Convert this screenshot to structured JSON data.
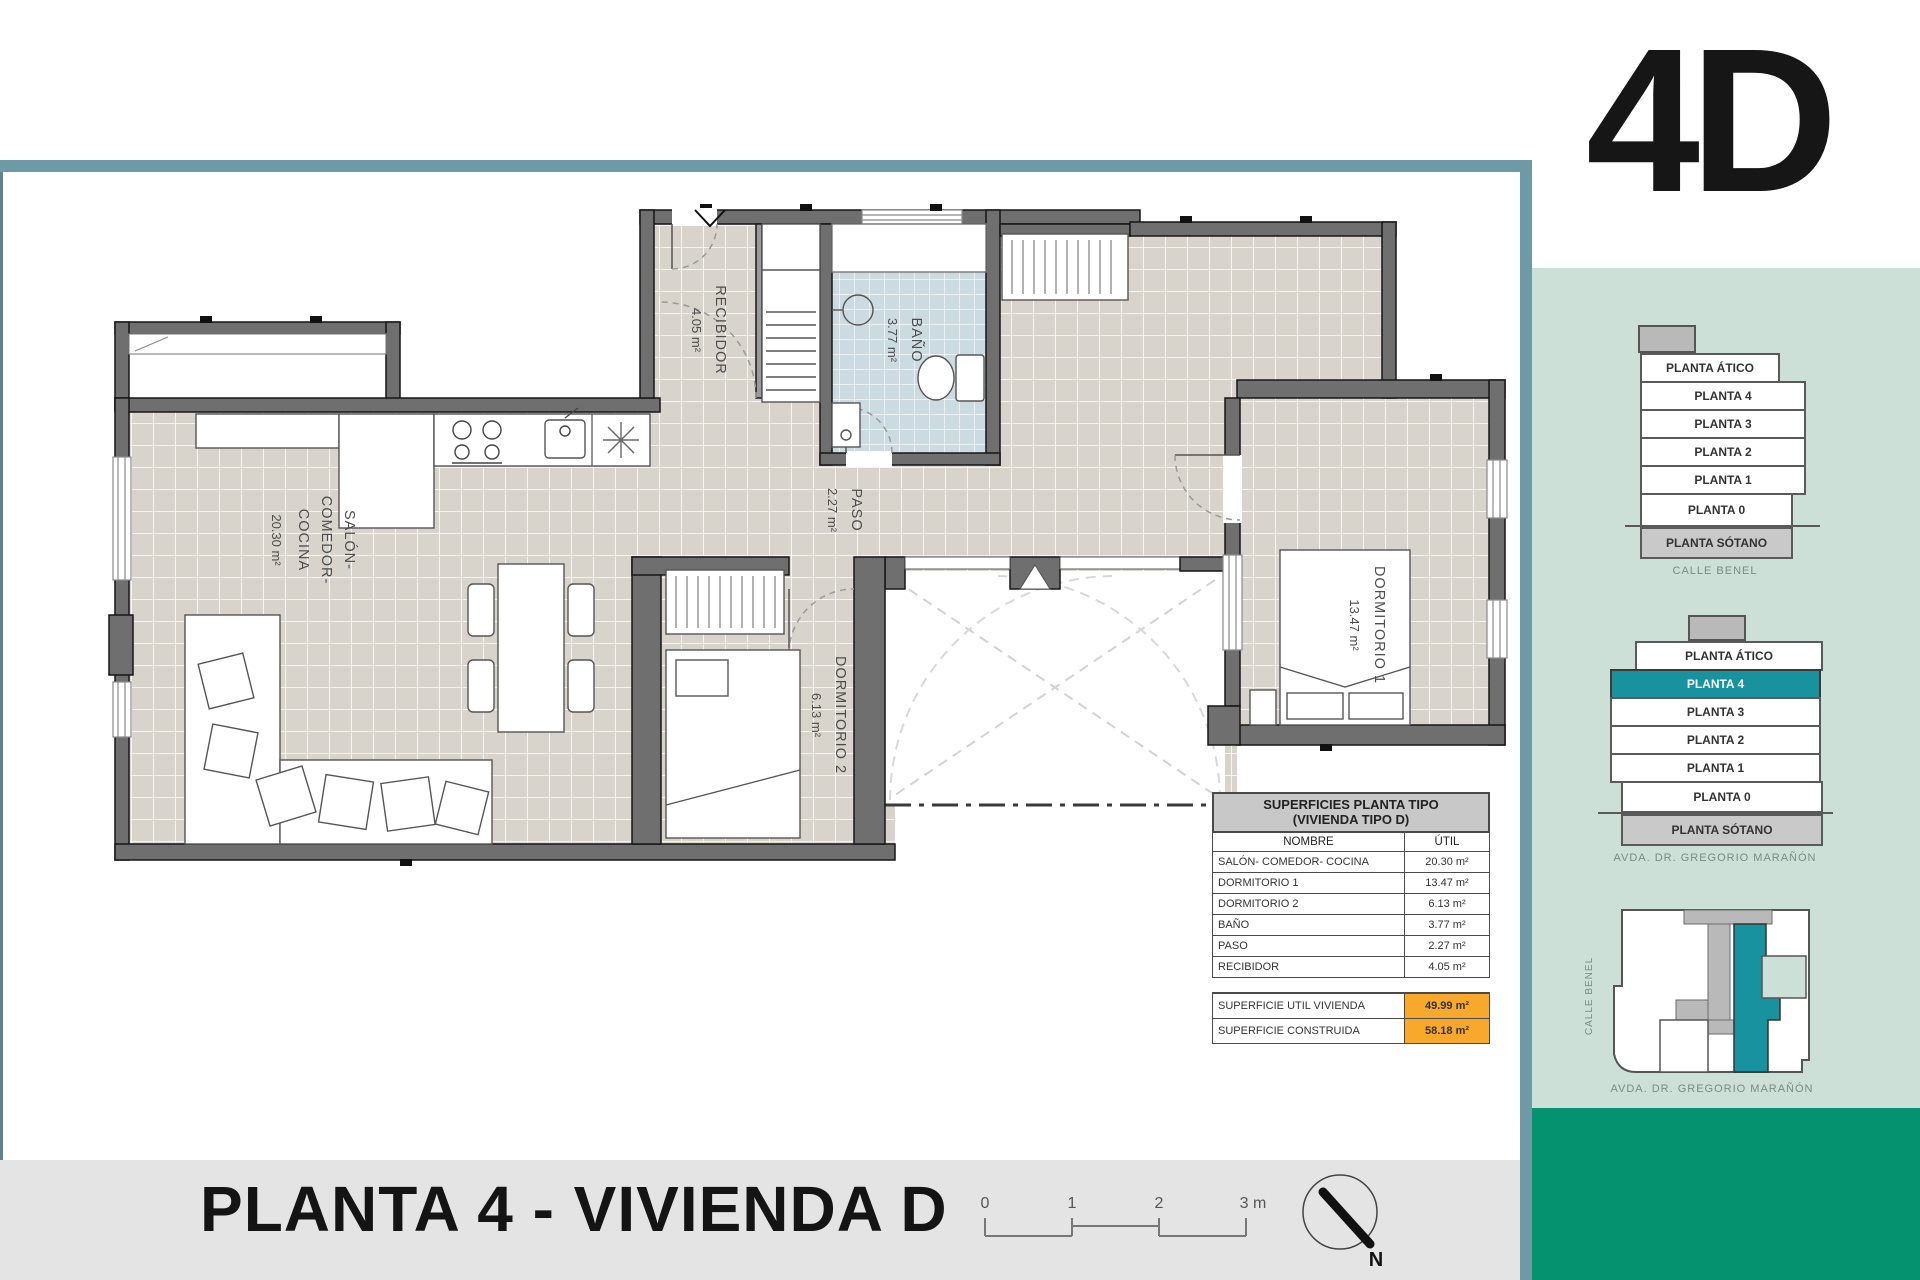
{
  "meta": {
    "unit_code": "4D",
    "sheet_title": "PLANTA 4 - VIVIENDA D"
  },
  "plan": {
    "rooms": {
      "salon": {
        "l1": "SALÓN-",
        "l2": "COMEDOR-",
        "l3": "COCINA",
        "area": "20.30 m²"
      },
      "recibidor": {
        "name": "RECIBIDOR",
        "area": "4.05 m²"
      },
      "bano": {
        "name": "BAÑO",
        "area": "3.77 m²"
      },
      "paso": {
        "name": "PASO",
        "area": "2.27 m²"
      },
      "dorm2": {
        "name": "DORMITORIO 2",
        "area": "6.13 m²"
      },
      "dorm1": {
        "name": "DORMITORIO 1",
        "area": "13.47 m²"
      }
    }
  },
  "table": {
    "title1": "SUPERFICIES PLANTA TIPO",
    "title2": "(VIVIENDA TIPO D)",
    "col1": "NOMBRE",
    "col2": "ÚTIL",
    "rows": [
      [
        "SALÓN- COMEDOR- COCINA",
        "20.30 m²"
      ],
      [
        "DORMITORIO 1",
        "13.47 m²"
      ],
      [
        "DORMITORIO 2",
        "6.13 m²"
      ],
      [
        "BAÑO",
        "3.77 m²"
      ],
      [
        "PASO",
        "2.27 m²"
      ],
      [
        "RECIBIDOR",
        "4.05 m²"
      ]
    ],
    "totals": [
      [
        "SUPERFICIE UTIL VIVIENDA",
        "49.99 m²"
      ],
      [
        "SUPERFICIE CONSTRUIDA",
        "58.18 m²"
      ]
    ]
  },
  "sidebar": {
    "unit_code": "4D",
    "stack_top": {
      "floors": [
        "PLANTA ÁTICO",
        "PLANTA 4",
        "PLANTA 3",
        "PLANTA 2",
        "PLANTA 1",
        "PLANTA 0",
        "PLANTA SÓTANO"
      ],
      "street": "CALLE BENEL"
    },
    "stack_bottom": {
      "floors": [
        "PLANTA ÁTICO",
        "PLANTA 4",
        "PLANTA 3",
        "PLANTA 2",
        "PLANTA 1",
        "PLANTA 0",
        "PLANTA SÓTANO"
      ],
      "active_floor": "PLANTA 4",
      "street": "AVDA. DR. GREGORIO MARAÑÓN"
    },
    "siteplan": {
      "street_left": "CALLE BENEL",
      "street_bottom": "AVDA. DR. GREGORIO MARAÑÓN"
    }
  },
  "footer": {
    "title": "PLANTA 4 - VIVIENDA D",
    "scale_ticks": [
      "0",
      "1",
      "2",
      "3 m"
    ],
    "north_label": "N"
  },
  "colors": {
    "accent_teal": "#17929e",
    "panel_green": "#cde0d7",
    "dark_green": "#04926f",
    "border_teal": "#6d9aa4",
    "highlight_orange": "#f8a82a",
    "band_gray": "#e4e4e4",
    "wall_gray": "#6f6f6f"
  }
}
